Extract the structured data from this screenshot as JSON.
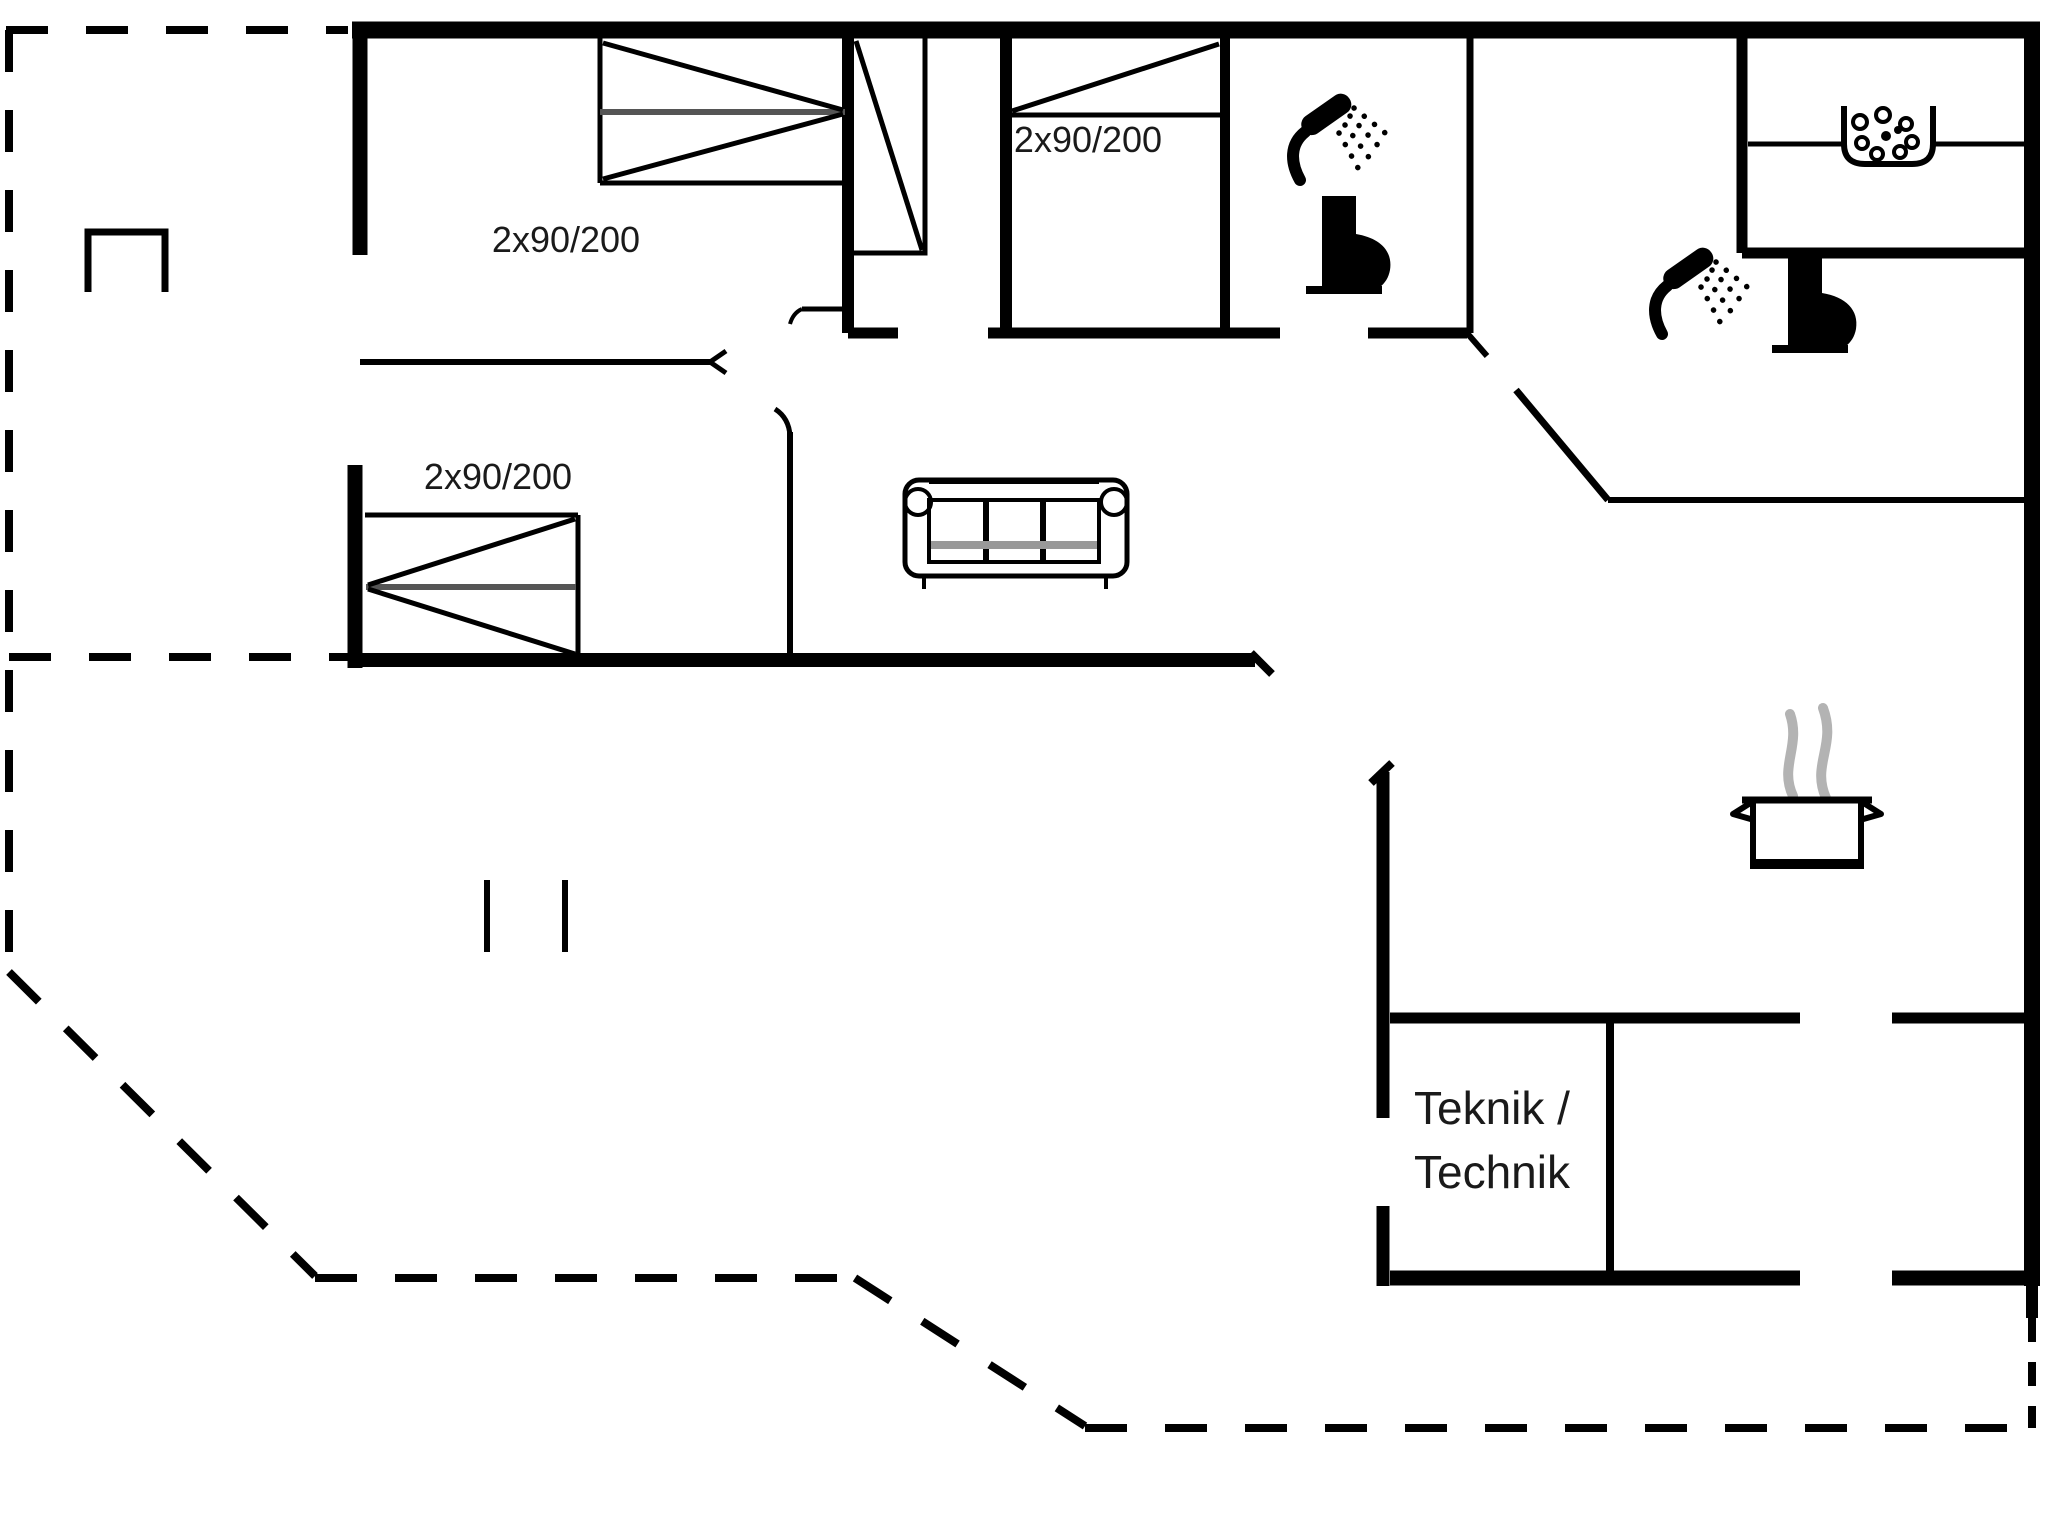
{
  "floorplan": {
    "type": "holiday-house floor plan",
    "labels": {
      "bed1_size": "2x90/200",
      "bed2_size": "2x90/200",
      "bed3_size": "2x90/200",
      "technical_room_line1": "Teknik /",
      "technical_room_line2": "Technik"
    },
    "icons": [
      "double-bed-symbol",
      "double-bed-symbol",
      "double-bed-symbol",
      "wardrobe-symbol",
      "sofa-symbol",
      "shower-icon",
      "toilet-icon",
      "shower-icon",
      "toilet-icon",
      "sink-basin-icon",
      "cooking-pot-icon",
      "steam-icon",
      "terrace-bench-symbol"
    ],
    "colors": {
      "walls": "#000000",
      "steam": "#b3b3b3",
      "text": "#1a1a1a",
      "background": "#ffffff",
      "bed_midline": "#555555"
    }
  }
}
